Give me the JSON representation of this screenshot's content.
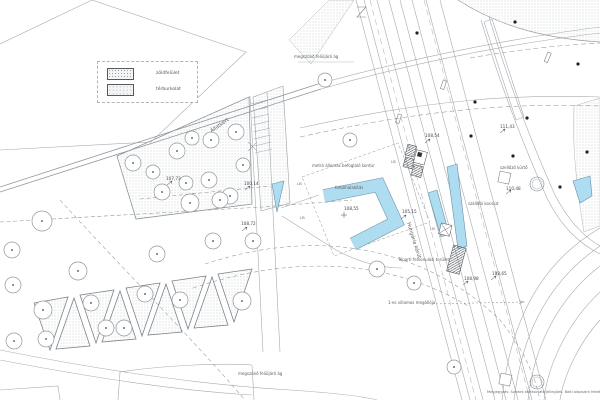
{
  "drawing": {
    "title": "urban site plan",
    "legend": {
      "items": [
        {
          "label": "zöldfelület"
        },
        {
          "label": "térburkolat"
        }
      ]
    },
    "labels": [
      {
        "text": "megszűnő felüljáró ág"
      },
      {
        "text": "megszűnő felüljáró ág"
      },
      {
        "text": "Állatkert"
      },
      {
        "text": "metró állomás befoglaló kontúr"
      },
      {
        "text": "felszínalakítás"
      },
      {
        "text": "Hungária körút"
      },
      {
        "text": "Tóparti felvonulási terület"
      },
      {
        "text": "1-es villamos megállója"
      },
      {
        "text": "szállítói kocsiút"
      },
      {
        "text": "szellőző kürtő"
      }
    ],
    "elevations": [
      {
        "v": "107,73"
      },
      {
        "v": "100,14"
      },
      {
        "v": "108,72"
      },
      {
        "v": "108,55"
      },
      {
        "v": "105,15"
      },
      {
        "v": "108,54"
      },
      {
        "v": "111,43"
      },
      {
        "v": "110,48"
      },
      {
        "v": "108,98"
      },
      {
        "v": "108,65"
      }
    ],
    "lb": [
      {
        "t": "LB"
      },
      {
        "t": "LB"
      },
      {
        "t": "LB"
      },
      {
        "t": "LB"
      }
    ],
    "note": {
      "text": "Megjegyzés: Szintek tájékoztató jellegűek. Balti alapszint felett é"
    },
    "colors": {
      "highlight_blue": "#aedcf0",
      "blue_outline": "#7d9cb0",
      "line_gray": "#a6abb0",
      "dark_line": "#44484c",
      "hatch_dot": "#b4bac0"
    }
  }
}
